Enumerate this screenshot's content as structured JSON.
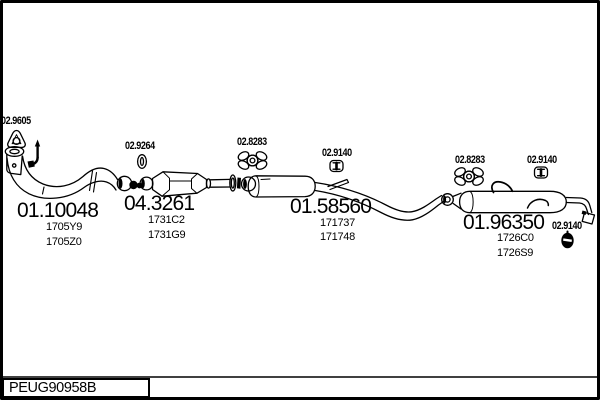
{
  "colors": {
    "ink": "#000000",
    "background": "#ffffff"
  },
  "footer": {
    "code": "PEUG90958B"
  },
  "diagram": {
    "hardware_labels": {
      "front_gasket": "02.9605",
      "front_clamp": "02.9264",
      "mid_mount": "02.8283",
      "mid_clamp": "02.9140",
      "rear_mount": "02.8283",
      "rear_clamp": "02.9140",
      "tail_mount": "02.9140"
    },
    "parts": {
      "front_pipe": {
        "number": "01.10048",
        "refs": [
          "1705Y9",
          "1705Z0"
        ]
      },
      "catalytic_converter": {
        "number": "04.3261",
        "refs": [
          "1731C2",
          "1731G9"
        ]
      },
      "middle_silencer": {
        "number": "01.58560",
        "refs": [
          "171737",
          "171748"
        ]
      },
      "rear_silencer": {
        "number": "01.96350",
        "refs": [
          "1726C0",
          "1726S9"
        ]
      }
    },
    "icons": {
      "front_gasket": "triangle-gasket-icon",
      "front_hanger": "hook-hanger-icon",
      "front_clamp": "oval-clamp-icon",
      "rubber_mount": "rubber-mount-icon",
      "pipe_clamp": "pipe-clamp-icon",
      "tail_mount": "filled-rubber-mount-icon"
    }
  }
}
